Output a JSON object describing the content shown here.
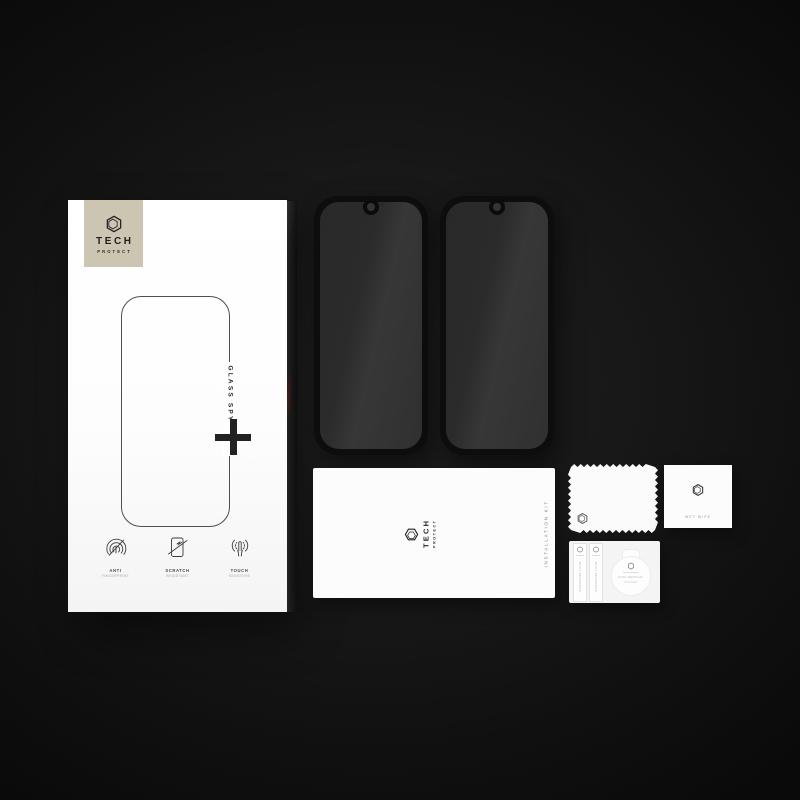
{
  "colors": {
    "background_center": "#202020",
    "background_edge": "#0a0a0a",
    "box_label_beige": "#cbc5b1",
    "glass_tint": "#2e2e2e",
    "frame_black": "#0d0d0d",
    "red_reflection": "#7c2a20"
  },
  "brand": {
    "name": "TECH",
    "sub": "PROTECT"
  },
  "box": {
    "product_line": "GLASS SPY",
    "plus_symbol": "+",
    "features": [
      {
        "icon": "anti-fingerprint-icon",
        "line1": "ANTI",
        "line2": "FINGERPRINT"
      },
      {
        "icon": "scratch-resistant-icon",
        "line1": "SCRATCH",
        "line2": "RESISTANT"
      },
      {
        "icon": "touch-sensitive-icon",
        "line1": "TOUCH",
        "line2": "SENSITIVE"
      }
    ]
  },
  "protectors": {
    "count": 2
  },
  "installation_kit": {
    "label": "INSTALLATION KIT"
  },
  "accessories": {
    "wet_wipe": {
      "label": "WET WIPE"
    },
    "dust_absorbers": [
      {
        "label": "DUST ABSORBER"
      },
      {
        "label": "DUST ABSORBER"
      }
    ],
    "removal_sticker": {
      "line1": "DUST REMOVAL",
      "line2": "STICKER"
    }
  }
}
